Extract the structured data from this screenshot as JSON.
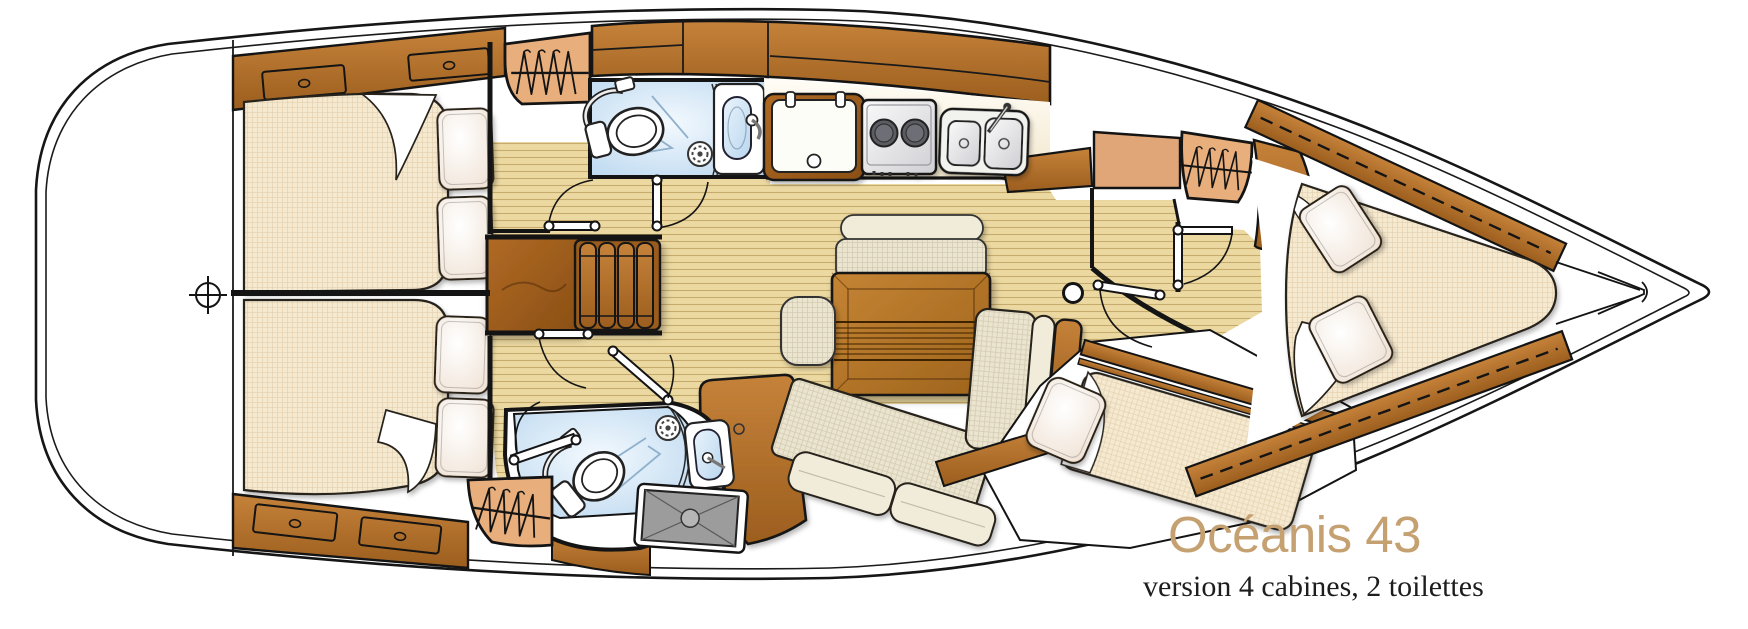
{
  "branding": {
    "title": "Océanis 43",
    "subtitle": "version 4 cabines, 2 toilettes"
  },
  "palette": {
    "title_color": "#c5a172",
    "subtitle_color": "#1d1d1d",
    "hull_outline": "#161616",
    "wood": "#b06d27",
    "wood_light": "#e8af7c",
    "floor": "#ecd9a2",
    "bathroom_blue": "#cfe3f4",
    "upholstery_cream": "#f5e9d0",
    "shower_tray_gray": "#9c9c9c",
    "hull_fill": "#ffffff"
  },
  "icons": [
    "helm-crosshair-icon",
    "hanging-locker-icon",
    "toilet-icon",
    "shower-drain-icon",
    "washbasin-icon",
    "fridge-icon",
    "stove-icon",
    "double-sink-icon",
    "companionway-steps-icon",
    "door-swing-icon",
    "mast-post-icon",
    "shower-tray-icon",
    "drawer-icon",
    "pillow-icon",
    "bow-shelf-icon"
  ]
}
